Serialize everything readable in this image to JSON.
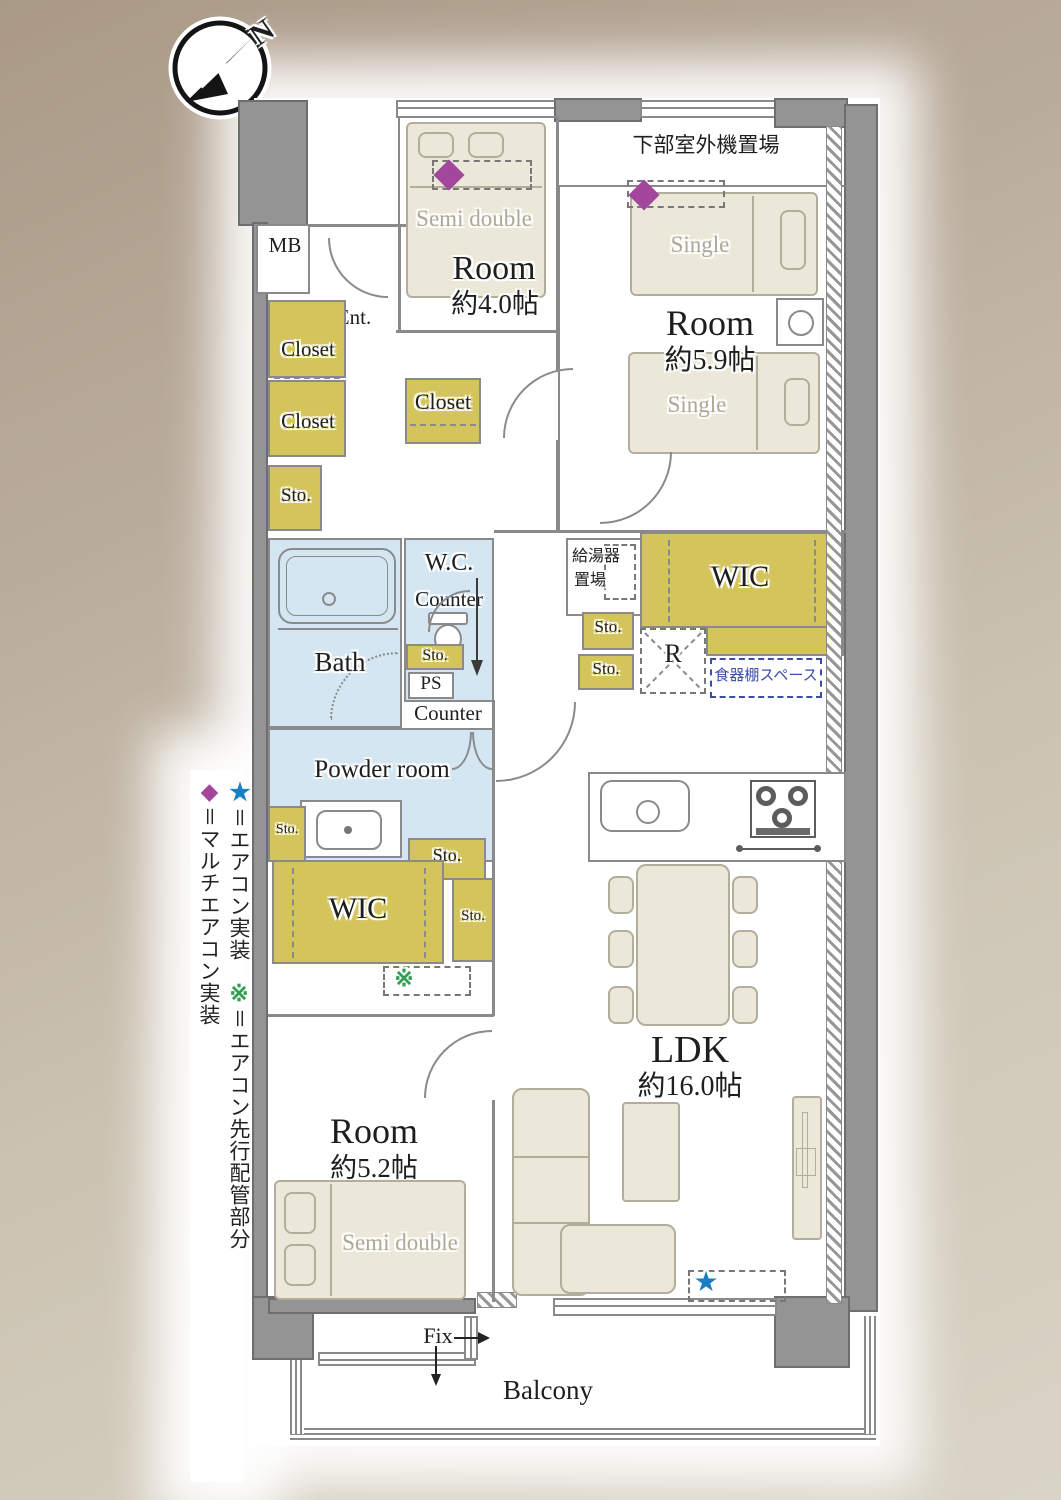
{
  "compass": {
    "north_label": "N"
  },
  "legend": {
    "items": [
      {
        "symbol": "★",
        "text": "＝エアコン実装",
        "color": "#1b7ec3"
      },
      {
        "symbol": "※",
        "text": "＝エアコン先行配管部分",
        "color": "#2f9e50"
      },
      {
        "symbol": "◆",
        "text": "＝マルチエアコン実装",
        "color": "#a3479d"
      }
    ]
  },
  "markers": {
    "ldk_star": "★",
    "pre_pipe_symbol": "※"
  },
  "rooms": {
    "room_nw": {
      "name": "Room",
      "size": "約4.0帖",
      "bed": "Semi double"
    },
    "room_ne": {
      "name": "Room",
      "size": "約5.9帖",
      "bed_upper": "Single",
      "bed_lower": "Single"
    },
    "room_sw": {
      "name": "Room",
      "size": "約5.2帖",
      "bed": "Semi double"
    },
    "ldk": {
      "name": "LDK",
      "size": "約16.0帖"
    },
    "bath": "Bath",
    "wc": "W.C.",
    "wc_counter": "Counter",
    "hall_counter": "Counter",
    "ps": "PS",
    "powder_room": "Powder room",
    "wic_east": "WIC",
    "wic_west": "WIC",
    "closet_hall_upper": "Closet",
    "closet_hall_lower": "Closet",
    "closet_room_nw": "Closet",
    "sto_hall": "Sto.",
    "sto_wc": "Sto.",
    "sto_boiler_upper": "Sto.",
    "sto_boiler_lower": "Sto.",
    "sto_powder_left": "Sto.",
    "sto_powder_right": "Sto.",
    "sto_ldk": "Sto.",
    "mb": "MB",
    "ent": "Ent.",
    "boiler_line1": "給湯器",
    "boiler_line2": "置場",
    "outdoor_unit": "下部室外機置場",
    "fridge": "R",
    "shelf_space": "食器棚スペース",
    "balcony": "Balcony",
    "fix": "Fix"
  },
  "colors": {
    "closet_yellow": "#d4c45c",
    "wet_area_blue": "#d4e6f2",
    "furniture_beige": "#ebe8d9",
    "wall_gray": "#949494",
    "diamond_purple": "#a3479d",
    "star_blue": "#1b7ec3",
    "kome_green": "#2f9e50",
    "shelf_navy": "#3b4ea5"
  }
}
